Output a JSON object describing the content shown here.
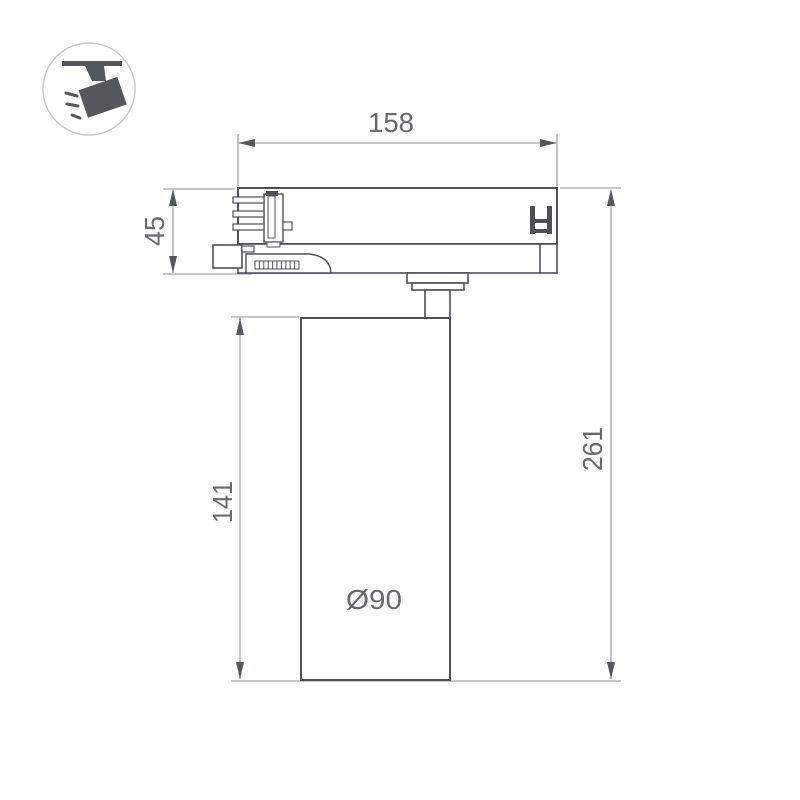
{
  "page": {
    "background_color": "#ffffff"
  },
  "badge": {
    "icon": "track-spotlight-icon",
    "circle_color": "#c6c8ca",
    "glyph_color": "#54585c"
  },
  "drawing": {
    "outline_color": "#4d5156",
    "dimension_line_color": "#8d9093",
    "dimension_text_color": "#67696c",
    "dimensions": {
      "adapter_width": "158",
      "adapter_height": "45",
      "body_height": "141",
      "total_height": "261",
      "body_diameter": "Ø90"
    }
  }
}
